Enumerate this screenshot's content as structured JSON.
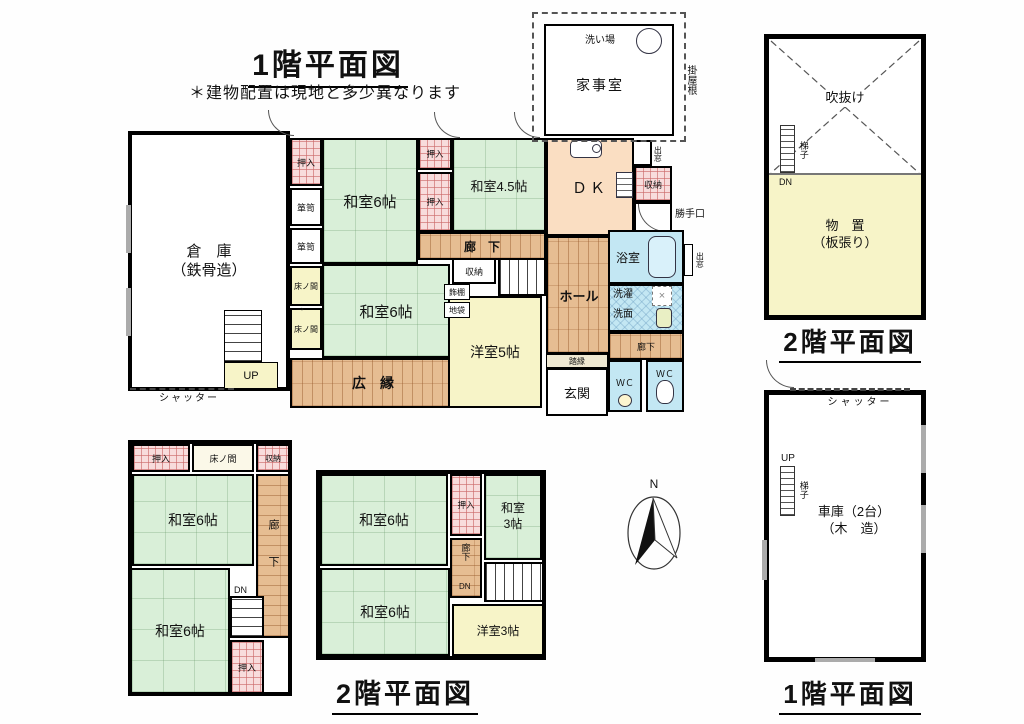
{
  "titles": {
    "floor1_main": "1階平面図",
    "note": "＊建物配置は現地と多少異なります",
    "floor2_annex": "2階平面図",
    "floor2_house": "2階平面図",
    "floor1_garage": "1階平面図"
  },
  "labels": {
    "souko": "倉　庫\n（鉄骨造）",
    "shutter": "シャッター",
    "up": "UP",
    "dn": "DN",
    "oshiire": "押入",
    "tansu": "箪笥",
    "tokonoma": "床ノ間",
    "washitsu6": "和室6帖",
    "washitsu45": "和室4.5帖",
    "washitsu3": "和室\n3帖",
    "yoshitsu5": "洋室5帖",
    "yoshitsu3": "洋室3帖",
    "rouka_wide": "廊　下",
    "rouka": "廊下",
    "hiroen": "広　縁",
    "hall": "ホール",
    "dk": "ＤＫ",
    "shuunou": "収納",
    "kazaridana": "飾棚",
    "jibukuro": "地袋",
    "demado": "出窓",
    "katteguchi": "勝手口",
    "yokushitsu": "浴室",
    "sentaku": "洗濯",
    "senmen": "洗面",
    "wc": "ＷＣ",
    "genkan": "玄関",
    "fumien": "踏縁",
    "kajishitsu": "家事室",
    "araiba": "洗い場",
    "kakeyane": "掛屋根",
    "fukinuke": "吹抜け",
    "hashigo": "梯子",
    "monooki": "物　置\n（板張り）",
    "shako": "車庫（2台）\n（木　造）",
    "arrow": "→",
    "cross": "×",
    "north": "N"
  },
  "colors": {
    "tatami": "#d9efd8",
    "wood": "#e6bd92",
    "closet_grid": "#cc6a6a",
    "water_blue": "#c3e7f3",
    "dk_peach": "#fadec2",
    "yellow_room": "#f7f4c8",
    "wall": "#000000"
  }
}
